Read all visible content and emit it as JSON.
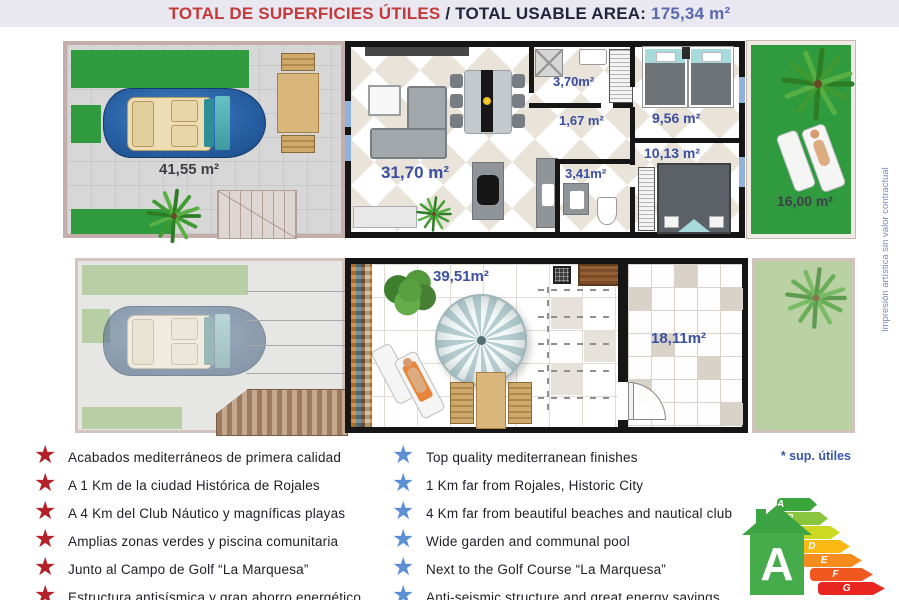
{
  "title": {
    "spanish": "TOTAL DE SUPERFICIES ÚTILES",
    "separator": " / ",
    "english": "TOTAL USABLE AREA: ",
    "value": "175,34 m²"
  },
  "plans": {
    "ground": {
      "parking": "41,55 m²",
      "living": "31,70 m²",
      "bath_top": "3,70m²",
      "hall": "1,67 m²",
      "bath_mid": "3,41m²",
      "bedroom_top": "9,56 m²",
      "bedroom_bottom": "10,13 m²",
      "garden": "16,00 m²"
    },
    "upper": {
      "terrace": "39,51m²",
      "room": "18,11m²"
    }
  },
  "features": {
    "spanish": [
      "Acabados mediterráneos de primera calidad",
      "A 1 Km de la ciudad Histórica de Rojales",
      "A 4 Km del Club Náutico y magníficas playas",
      "Amplias zonas verdes y piscina comunitaria",
      "Junto al Campo de Golf “La Marquesa”",
      "Estructura antisísmica y gran ahorro energético"
    ],
    "english": [
      "Top quality mediterranean finishes",
      "1 Km far from Rojales, Historic City",
      "4 Km far from beautiful beaches and nautical club",
      "Wide garden and communal pool",
      "Next to the Golf Course “La Marquesa”",
      "Anti-seismic structure and great energy savings"
    ]
  },
  "footnote": "* sup. útiles",
  "watermark": "Impresión artística sin valor contractual",
  "icons": {
    "star": "★"
  },
  "energy": {
    "rating": "A",
    "levels": [
      {
        "letter": "A",
        "color": "#3aa53a"
      },
      {
        "letter": "B",
        "color": "#8bc53f"
      },
      {
        "letter": "C",
        "color": "#cdd921"
      },
      {
        "letter": "D",
        "color": "#fbb812"
      },
      {
        "letter": "E",
        "color": "#f68b1e"
      },
      {
        "letter": "F",
        "color": "#f0581f"
      },
      {
        "letter": "G",
        "color": "#e8251e"
      }
    ]
  },
  "colors": {
    "title_red": "#c23a3c",
    "title_navy": "#23233c",
    "title_value_blue": "#5a68ae",
    "area_label_blue": "#3a4fa0",
    "area_label_dark": "#3f3f49",
    "star_red": "#b5212b",
    "star_blue": "#5d8fd4",
    "grass_green": "#2f9b3e",
    "wall_black": "#161616",
    "footnote_blue": "#3a56ad",
    "energy_house_green": "#45ab4b"
  }
}
